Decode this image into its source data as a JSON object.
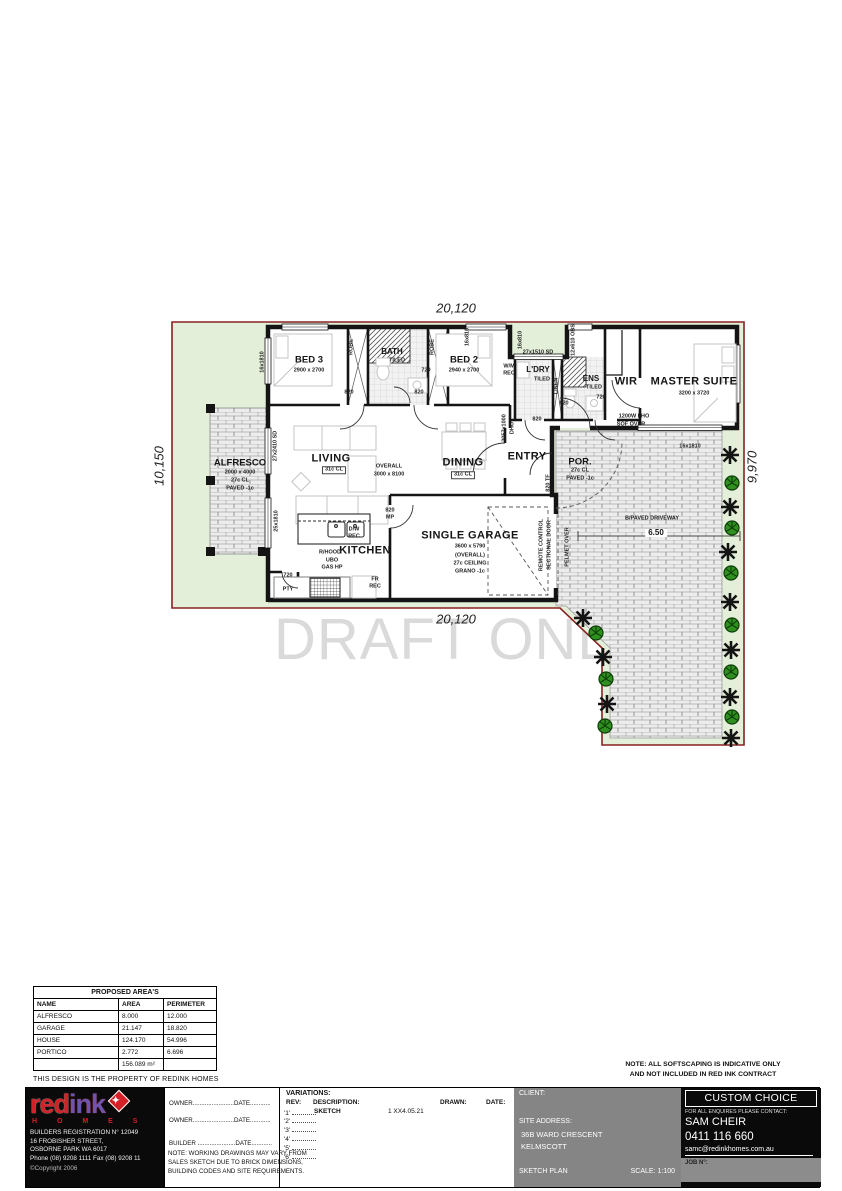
{
  "watermark": "DRAFT ONLY",
  "plan": {
    "labels": [
      {
        "id": "dim-top",
        "x": 456,
        "y": 308,
        "t": "20,120",
        "c": "dim"
      },
      {
        "id": "dim-bottom",
        "x": 456,
        "y": 619,
        "t": "20,120",
        "c": "dim"
      },
      {
        "id": "dim-left",
        "x": 159,
        "y": 466,
        "t": "10,150",
        "c": "dim",
        "r": -90
      },
      {
        "id": "dim-right",
        "x": 752,
        "y": 467,
        "t": "9,970",
        "c": "dim",
        "r": -90
      },
      {
        "id": "bed3-name",
        "x": 309,
        "y": 360,
        "t": "BED 3",
        "c": "lg"
      },
      {
        "id": "bed3-size",
        "x": 309,
        "y": 371,
        "t": "2900 x 2700",
        "c": "xs"
      },
      {
        "id": "bed3-window",
        "x": 263,
        "y": 362,
        "t": "16x1810",
        "c": "xs",
        "r": -90
      },
      {
        "id": "bath-name",
        "x": 392,
        "y": 352,
        "t": "BATH",
        "c": "md"
      },
      {
        "id": "bath-tiled",
        "x": 397,
        "y": 361,
        "t": "TILED",
        "c": "xs"
      },
      {
        "id": "bath-door",
        "x": 426,
        "y": 371,
        "t": "720",
        "c": "xs"
      },
      {
        "id": "robe-bed3",
        "x": 352,
        "y": 347,
        "t": "ROBE",
        "c": "xs",
        "r": -90
      },
      {
        "id": "robe-bed2",
        "x": 433,
        "y": 347,
        "t": "ROBE",
        "c": "xs",
        "r": -90
      },
      {
        "id": "bed2-name",
        "x": 464,
        "y": 360,
        "t": "BED 2",
        "c": "lg"
      },
      {
        "id": "bed2-size",
        "x": 464,
        "y": 371,
        "t": "2940 x 2700",
        "c": "xs"
      },
      {
        "id": "hall-door-1",
        "x": 349,
        "y": 393,
        "t": "820",
        "c": "xs"
      },
      {
        "id": "hall-door-2",
        "x": 419,
        "y": 393,
        "t": "820",
        "c": "xs"
      },
      {
        "id": "notch-window-1",
        "x": 468,
        "y": 337,
        "t": "16x810",
        "c": "xs",
        "r": -90
      },
      {
        "id": "notch-window-2",
        "x": 521,
        "y": 340,
        "t": "16x810",
        "c": "xs",
        "r": -90
      },
      {
        "id": "sd-top",
        "x": 538,
        "y": 353,
        "t": "27x1510 SD",
        "c": "xs"
      },
      {
        "id": "obs-window",
        "x": 574,
        "y": 340,
        "t": "12x610 OBS",
        "c": "xs",
        "r": -90
      },
      {
        "id": "wm-1",
        "x": 509,
        "y": 367,
        "t": "W/M",
        "c": "xs"
      },
      {
        "id": "wm-2",
        "x": 509,
        "y": 374,
        "t": "REC",
        "c": "xs"
      },
      {
        "id": "ldry-name",
        "x": 538,
        "y": 370,
        "t": "L'DRY",
        "c": "md"
      },
      {
        "id": "ldry-tiled",
        "x": 542,
        "y": 380,
        "t": "TILED",
        "c": "xs"
      },
      {
        "id": "ldry-door",
        "x": 537,
        "y": 420,
        "t": "820",
        "c": "xs"
      },
      {
        "id": "linen",
        "x": 557,
        "y": 386,
        "t": "LINEN",
        "c": "xs",
        "r": -90
      },
      {
        "id": "ens-name",
        "x": 591,
        "y": 379,
        "t": "ENS",
        "c": "md"
      },
      {
        "id": "ens-tiled",
        "x": 594,
        "y": 388,
        "t": "TILED",
        "c": "xs"
      },
      {
        "id": "ens-door",
        "x": 601,
        "y": 398,
        "t": "720",
        "c": "xs"
      },
      {
        "id": "hall-door-3",
        "x": 564,
        "y": 404,
        "t": "820",
        "c": "xs"
      },
      {
        "id": "wir-name",
        "x": 626,
        "y": 382,
        "t": "WIR",
        "c": "xl"
      },
      {
        "id": "master-name",
        "x": 694,
        "y": 382,
        "t": "MASTER SUITE",
        "c": "xl"
      },
      {
        "id": "master-size",
        "x": 694,
        "y": 394,
        "t": "3200 x 3720",
        "c": "xs"
      },
      {
        "id": "pho-1",
        "x": 634,
        "y": 417,
        "t": "1200W FHO",
        "c": "xs"
      },
      {
        "id": "pho-2",
        "x": 631,
        "y": 425,
        "t": "SOF OVER",
        "c": "xs"
      },
      {
        "id": "master-window",
        "x": 690,
        "y": 447,
        "t": "16x1810",
        "c": "xs"
      },
      {
        "id": "alfresco-name",
        "x": 240,
        "y": 463,
        "t": "ALFRESCO",
        "c": "lg"
      },
      {
        "id": "alfresco-size",
        "x": 240,
        "y": 473,
        "t": "2000 x 4000",
        "c": "xs"
      },
      {
        "id": "alfresco-cl",
        "x": 240,
        "y": 481,
        "t": "27c CL",
        "c": "xs"
      },
      {
        "id": "alfresco-paved",
        "x": 240,
        "y": 489,
        "t": "PAVED -1c",
        "c": "xs"
      },
      {
        "id": "alfresco-sd",
        "x": 276,
        "y": 446,
        "t": "27x2410 SD",
        "c": "xs",
        "r": -90
      },
      {
        "id": "kitchen-window",
        "x": 277,
        "y": 521,
        "t": "25x1810",
        "c": "xs",
        "r": -90
      },
      {
        "id": "living-name",
        "x": 331,
        "y": 459,
        "t": "LIVING",
        "c": "xl"
      },
      {
        "id": "living-cl",
        "x": 334,
        "y": 470,
        "t": "31c CL",
        "c": "xs",
        "b": 1
      },
      {
        "id": "overall-1",
        "x": 389,
        "y": 467,
        "t": "OVERALL",
        "c": "xs"
      },
      {
        "id": "overall-2",
        "x": 389,
        "y": 475,
        "t": "3000 x 8100",
        "c": "xs"
      },
      {
        "id": "dining-name",
        "x": 463,
        "y": 463,
        "t": "DINING",
        "c": "xl"
      },
      {
        "id": "dining-cl",
        "x": 463,
        "y": 475,
        "t": "31c CL",
        "c": "xs",
        "b": 1
      },
      {
        "id": "entry-name",
        "x": 527,
        "y": 457,
        "t": "ENTRY",
        "c": "xl"
      },
      {
        "id": "dho-1",
        "x": 505,
        "y": 428,
        "t": "2057x1000",
        "c": "xs",
        "r": -90
      },
      {
        "id": "dho-2",
        "x": 513,
        "y": 428,
        "t": "DHO",
        "c": "xs",
        "r": -90
      },
      {
        "id": "entry-door",
        "x": 549,
        "y": 483,
        "t": "820 TF",
        "c": "xs",
        "r": -90
      },
      {
        "id": "por-name",
        "x": 580,
        "y": 462,
        "t": "POR.",
        "c": "lg"
      },
      {
        "id": "por-cl",
        "x": 580,
        "y": 471,
        "t": "27c CL",
        "c": "xs"
      },
      {
        "id": "por-paved",
        "x": 580,
        "y": 479,
        "t": "PAVED -1c",
        "c": "xs"
      },
      {
        "id": "kitchen-name",
        "x": 365,
        "y": 551,
        "t": "KITCHEN",
        "c": "xl"
      },
      {
        "id": "rhood",
        "x": 330,
        "y": 553,
        "t": "R/HOOD",
        "c": "xs"
      },
      {
        "id": "ubo",
        "x": 332,
        "y": 561,
        "t": "UBO",
        "c": "xs"
      },
      {
        "id": "gashp",
        "x": 332,
        "y": 568,
        "t": "GAS HP",
        "c": "xs"
      },
      {
        "id": "dw-1",
        "x": 354,
        "y": 530,
        "t": "D/W",
        "c": "xs"
      },
      {
        "id": "dw-2",
        "x": 354,
        "y": 537,
        "t": "REC",
        "c": "xs"
      },
      {
        "id": "fr-1",
        "x": 375,
        "y": 580,
        "t": "FR",
        "c": "xs"
      },
      {
        "id": "fr-2",
        "x": 375,
        "y": 587,
        "t": "REC",
        "c": "xs"
      },
      {
        "id": "pty-door",
        "x": 288,
        "y": 576,
        "t": "720",
        "c": "xs"
      },
      {
        "id": "pty",
        "x": 288,
        "y": 590,
        "t": "PTY",
        "c": "xs"
      },
      {
        "id": "mp-1",
        "x": 390,
        "y": 511,
        "t": "820",
        "c": "xs"
      },
      {
        "id": "mp-2",
        "x": 390,
        "y": 518,
        "t": "MP",
        "c": "xs"
      },
      {
        "id": "garage-name",
        "x": 470,
        "y": 536,
        "t": "SINGLE GARAGE",
        "c": "xl"
      },
      {
        "id": "garage-size",
        "x": 470,
        "y": 547,
        "t": "3600 x 5790",
        "c": "xs"
      },
      {
        "id": "garage-overall",
        "x": 470,
        "y": 556,
        "t": "(OVERALL)",
        "c": "xs"
      },
      {
        "id": "garage-ceiling",
        "x": 470,
        "y": 564,
        "t": "27c CEILING",
        "c": "xs"
      },
      {
        "id": "garage-floor",
        "x": 470,
        "y": 572,
        "t": "GRANO -1c",
        "c": "xs"
      },
      {
        "id": "remote-1",
        "x": 542,
        "y": 545,
        "t": "REMOTE CONTROL",
        "c": "xs",
        "r": -90
      },
      {
        "id": "remote-2",
        "x": 550,
        "y": 545,
        "t": "SECTIONAL DOOR",
        "c": "xs",
        "r": -90
      },
      {
        "id": "pelmet",
        "x": 568,
        "y": 547,
        "t": "PELMET OVER",
        "c": "xs",
        "r": -90
      },
      {
        "id": "driveway-label",
        "x": 652,
        "y": 519,
        "t": "B/PAVED DRIVEWAY",
        "c": "xs"
      },
      {
        "id": "driveway-width",
        "x": 656,
        "y": 533,
        "t": "6.50",
        "c": "md",
        "w": 1
      }
    ]
  },
  "areas_table": {
    "title": "PROPOSED AREA'S",
    "columns": [
      "NAME",
      "AREA",
      "PERIMETER"
    ],
    "rows": [
      [
        "ALFRESCO",
        "8.000",
        "12.000"
      ],
      [
        "GARAGE",
        "21.147",
        "18.820"
      ],
      [
        "HOUSE",
        "124.170",
        "54.996"
      ],
      [
        "PORTICO",
        "2.772",
        "6.696"
      ]
    ],
    "total": "156.089 m²"
  },
  "property_note": "THIS DESIGN IS THE PROPERTY OF REDINK HOMES",
  "softscaping_note": [
    "NOTE: ALL SOFTSCAPING IS INDICATIVE ONLY",
    "AND NOT INCLUDED IN RED INK CONTRACT"
  ],
  "title_block": {
    "logo": {
      "part1": "red",
      "part2": "ink",
      "star": "✦",
      "homes": "H O M E S"
    },
    "builder": {
      "lines": [
        "BUILDERS REGISTRATION N° 12049",
        "16 FROBISHER STREET,",
        "OSBORNE PARK WA 6017",
        "Phone (08) 9208 1111 Fax (08) 9208 11"
      ],
      "copyright": "©Copyright 2006"
    },
    "signatures": {
      "lines": [
        "OWNER........................DATE............",
        "OWNER........................DATE............",
        "BUILDER ......................DATE............"
      ],
      "note": [
        "NOTE: WORKING DRAWINGS MAY VARY FROM",
        "SALES SKETCH DUE TO BRICK DIMENSIONS,",
        "BUILDING CODES AND SITE REQUIREMENTS."
      ]
    },
    "variations": {
      "heading": "VARIATIONS:",
      "headers": {
        "rev": "REV:",
        "description": "DESCRIPTION:",
        "drawn": "DRAWN:",
        "date": "DATE:"
      },
      "first_row": {
        "rev": "'1'",
        "description": "SKETCH",
        "code": "1 XX4.05.21"
      },
      "revs": [
        "'2'",
        "'3'",
        "'4'",
        "'5'",
        "'6'"
      ]
    },
    "client": {
      "label": "CLIENT:",
      "site_address_label": "SITE ADDRESS:",
      "address_line1": "36B WARD CRESCENT",
      "address_line2": "KELMSCOTT",
      "drawing_type": "SKETCH PLAN",
      "scale": "SCALE: 1:100"
    },
    "contact": {
      "brand": "CUSTOM CHOICE",
      "prompt": "FOR ALL ENQUIRES PLEASE CONTACT:",
      "name": "SAM CHEIR",
      "phone": "0411 116 660",
      "email": "samc@redinkhomes.com.au",
      "job_label": "JOB N°:"
    }
  }
}
